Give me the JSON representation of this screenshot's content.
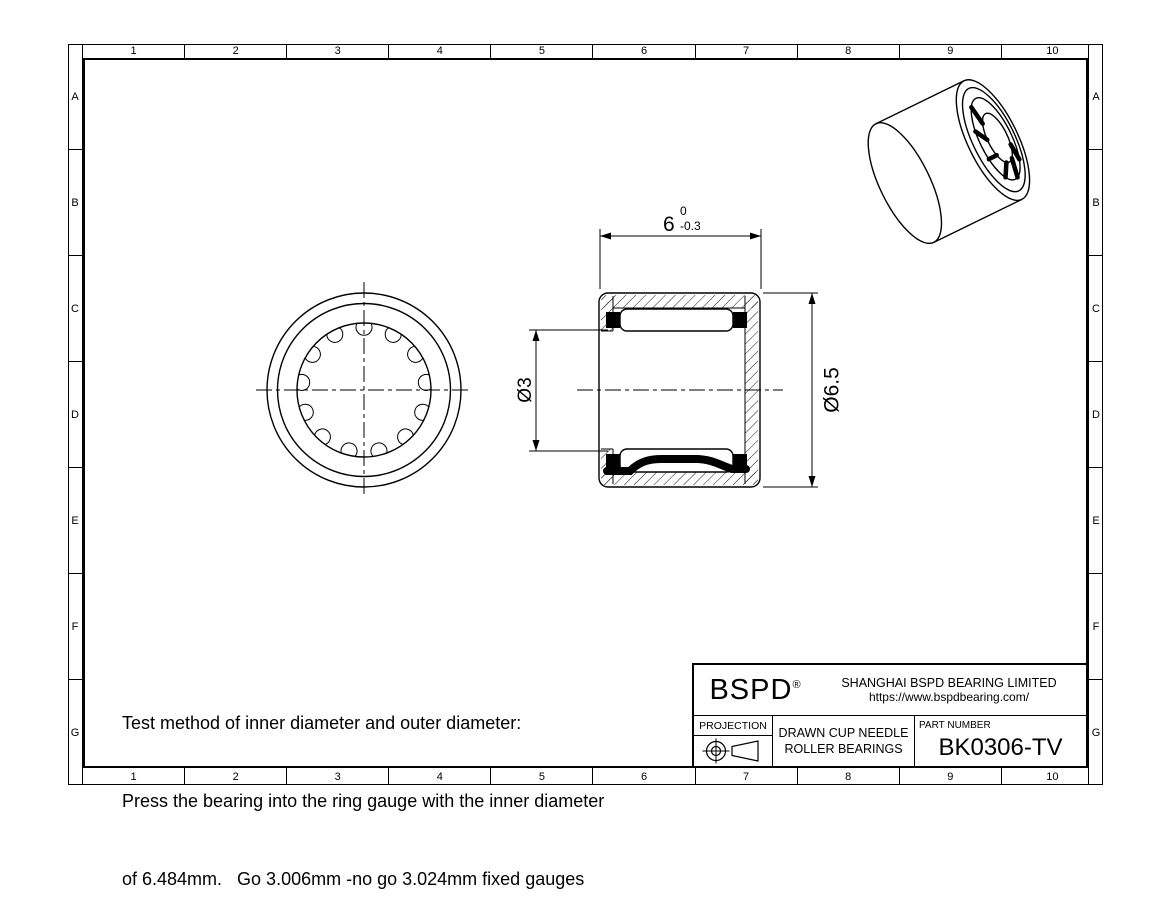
{
  "grid": {
    "columns": [
      "1",
      "2",
      "3",
      "4",
      "5",
      "6",
      "7",
      "8",
      "9",
      "10"
    ],
    "rows": [
      "A",
      "B",
      "C",
      "D",
      "E",
      "F",
      "G"
    ]
  },
  "dimensions": {
    "width": {
      "value": "6",
      "tol_upper": "0",
      "tol_lower": "-0.3"
    },
    "bore": {
      "label": "Ø3"
    },
    "outer": {
      "label": "Ø6.5"
    }
  },
  "notes": {
    "line1": "Test method of inner diameter and outer diameter:",
    "line2": "Press the bearing into the ring gauge with the inner diameter",
    "line3": "of 6.484mm.   Go 3.006mm -no go 3.024mm fixed gauges"
  },
  "title_block": {
    "logo": "BSPD",
    "registered": "®",
    "company": "SHANGHAI BSPD BEARING LIMITED",
    "website": "https://www.bspdbearing.com/",
    "projection_label": "PROJECTION",
    "product_line1": "DRAWN CUP NEEDLE",
    "product_line2": "ROLLER BEARINGS",
    "part_number_label": "PART NUMBER",
    "part_number": "BK0306-TV"
  },
  "colors": {
    "line": "#000000",
    "background": "#ffffff"
  }
}
